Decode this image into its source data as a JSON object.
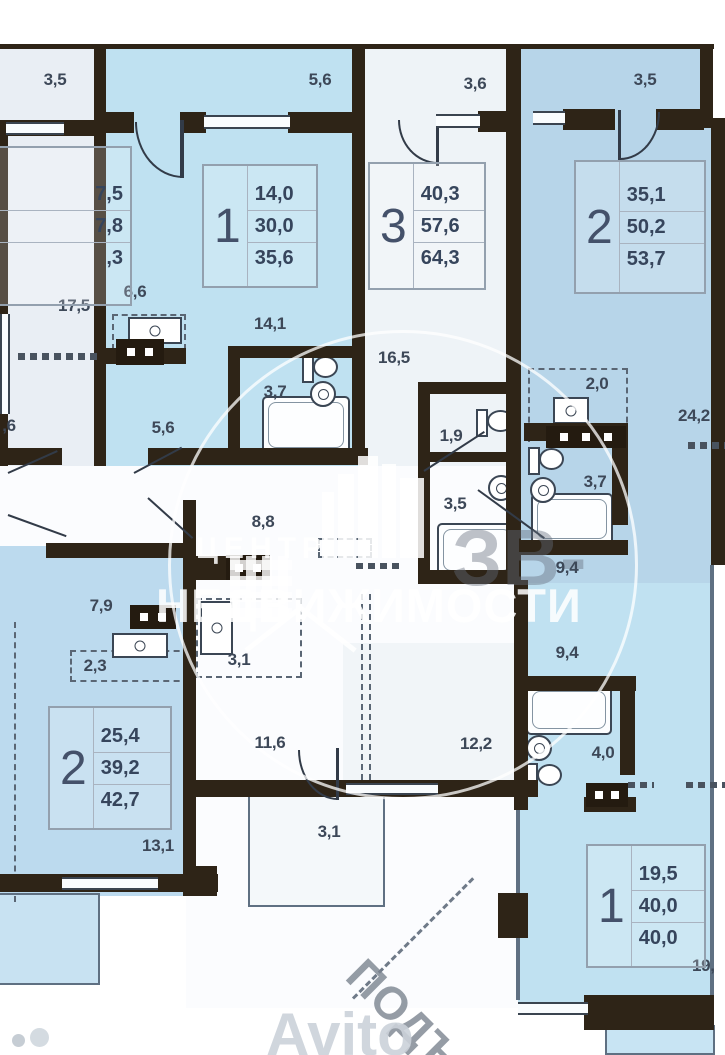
{
  "plan": {
    "watermark": {
      "line1": "ЦЕНТР",
      "line2": "НЕДВИЖИМОСТИ",
      "badge": "ЗВ-",
      "diagonal_text": "ПОДЪ",
      "brand": "Avito"
    },
    "apartments": {
      "left_partial": {
        "values": [
          "7,5",
          "7,8",
          ",3"
        ]
      },
      "apt1_top": {
        "number": "1",
        "values": [
          "14,0",
          "30,0",
          "35,6"
        ]
      },
      "apt3_top": {
        "number": "3",
        "values": [
          "40,3",
          "57,6",
          "64,3"
        ]
      },
      "apt2_top": {
        "number": "2",
        "values": [
          "35,1",
          "50,2",
          "53,7"
        ]
      },
      "apt2_bottom": {
        "number": "2",
        "values": [
          "25,4",
          "39,2",
          "42,7"
        ]
      },
      "apt1_bottom": {
        "number": "1",
        "values": [
          "19,5",
          "40,0",
          "40,0"
        ]
      }
    },
    "labels": {
      "balcony_top_left": "3,5",
      "balcony_apt1": "5,6",
      "balcony_apt3": "3,6",
      "balcony_apt2": "3,5",
      "room_left": "17,5",
      "partial_left": ",6",
      "kitchen_apt1": "6,6",
      "hall_apt1": "5,6",
      "bedroom_apt1": "14,1",
      "bath_apt1": "3,7",
      "hall_apt3": "16,5",
      "wc_apt3": "1,9",
      "bath_apt3": "3,5",
      "niche_apt2": "2,0",
      "living_apt2": "24,2",
      "bath_apt2": "3,7",
      "hall_apt2": "9,4",
      "corridor": "8,8",
      "room_7_9": "7,9",
      "counter_2_3": "2,3",
      "wardrobe": "3,1",
      "hall_11_6": "11,6",
      "room_12_2": "12,2",
      "balcony_3_1": "3,1",
      "room_13_1": "13,1",
      "hall_apt1b": "9,4",
      "bath_apt1b": "4,0",
      "balcony_19": "19,"
    },
    "colors": {
      "wall": "#2e2417",
      "apartment_blue": "#bfe1f1",
      "apartment_blue_dark": "#b7d5e9",
      "apartment_light": "#eef3f7",
      "label_text": "#3d4858"
    }
  }
}
